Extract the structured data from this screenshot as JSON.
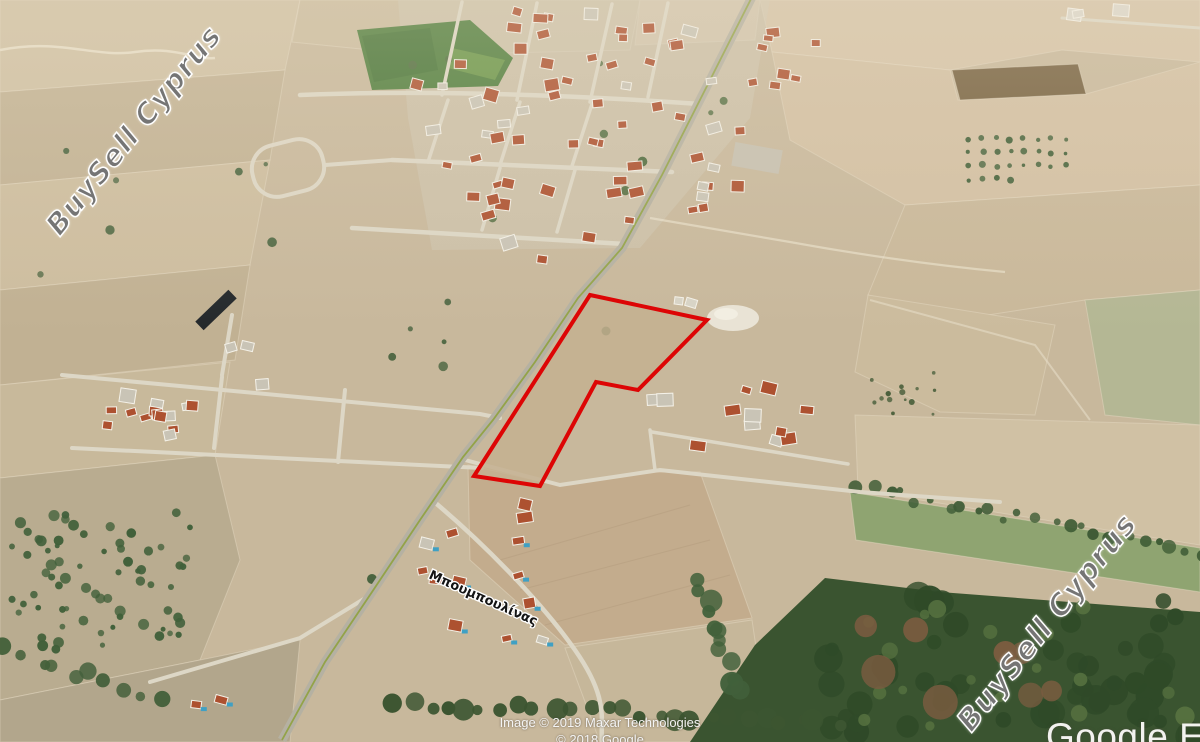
{
  "watermark": {
    "text": "BuySell Cyprus",
    "positions": [
      "top-left",
      "bottom-right"
    ]
  },
  "map": {
    "street_label": "Μπουμπουλίνας",
    "plot_outline_points": "590,295 707,320 638,390 596,382 540,486 474,476",
    "plot_outline_color": "#dd0505"
  },
  "attribution": {
    "line1": "Image © 2019 Maxar Technologies",
    "line2": "© 2018 Google"
  },
  "logo_text": "Google Earth",
  "colors": {
    "terrain_base": "#c8b89c",
    "green_field": "#4e7d3c",
    "forest": "#3a5430",
    "main_road": "#b5b1a2",
    "road_stripe": "#8fa23e",
    "house_roof": "#ad5130",
    "pool": "#3fa0c4",
    "plot_red": "#dd0505"
  }
}
